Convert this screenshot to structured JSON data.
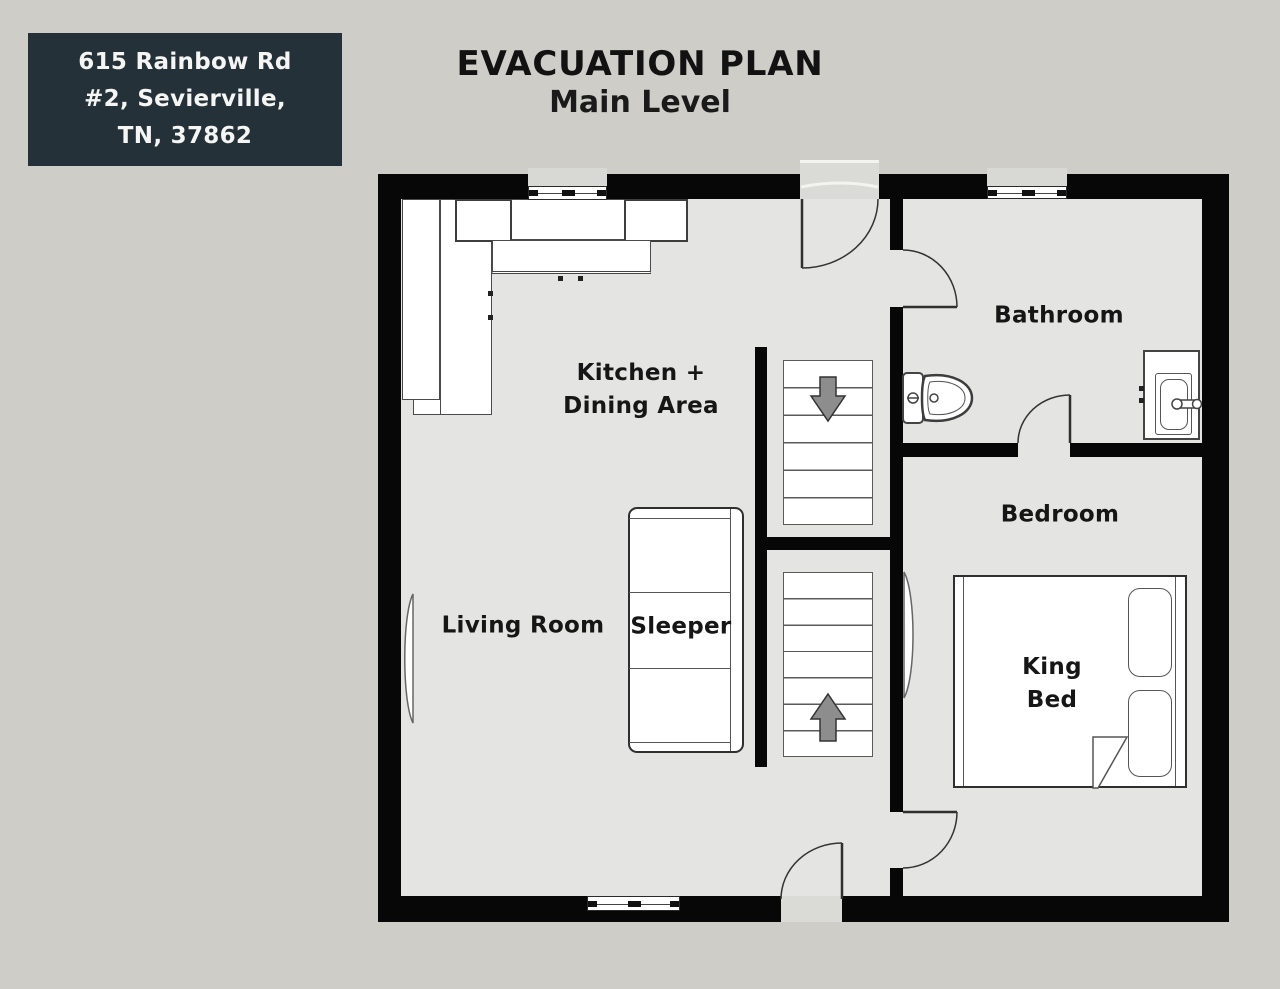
{
  "address": {
    "line1": "615 Rainbow Rd",
    "line2": "#2, Sevierville,",
    "line3": "TN, 37862"
  },
  "title": {
    "main": "EVACUATION PLAN",
    "sub": "Main Level"
  },
  "rooms": {
    "kitchen": {
      "label_line1": "Kitchen +",
      "label_line2": "Dining Area"
    },
    "bathroom": {
      "label": "Bathroom"
    },
    "bedroom": {
      "label": "Bedroom",
      "bed_label_line1": "King",
      "bed_label_line2": "Bed"
    },
    "living_room": {
      "label": "Living Room",
      "sofa_label": "Sleeper"
    }
  },
  "colors": {
    "background": "#cecdc8",
    "floor": "#e4e4e2",
    "wall": "#070707",
    "address_box_bg": "#243139",
    "address_text": "#f5f5f4",
    "label_text": "#161616",
    "arrow_fill": "#8d8d8d",
    "furniture_fill": "#ffffff",
    "furniture_border": "#4a4a4a"
  }
}
